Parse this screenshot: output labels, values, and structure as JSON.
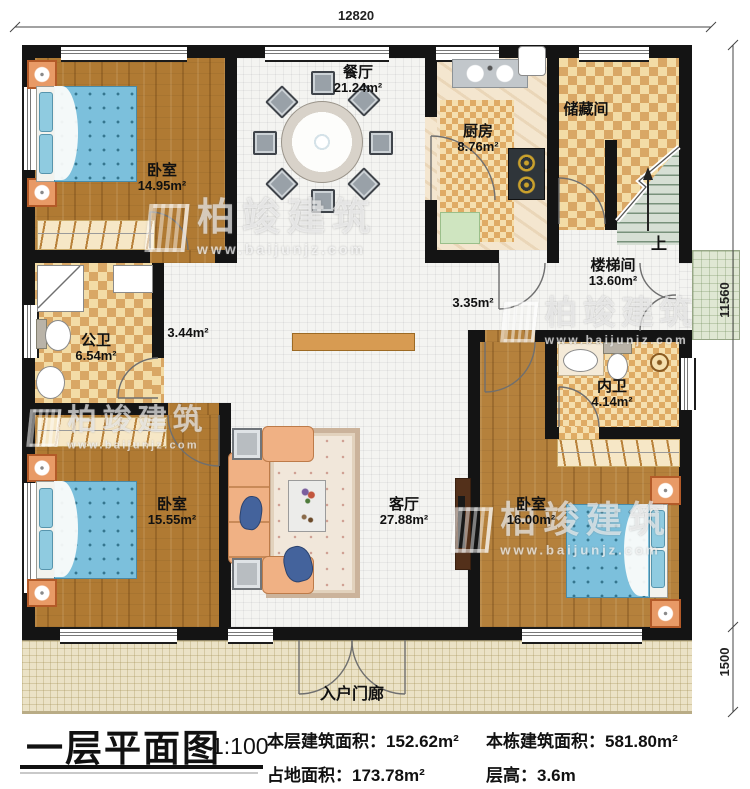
{
  "plan": {
    "title": "一层平面图",
    "scale": "1:100",
    "stats": [
      {
        "label": "本层建筑面积：",
        "value": "152.62m²"
      },
      {
        "label": "本栋建筑面积：",
        "value": "581.80m²"
      },
      {
        "label": "占地面积：",
        "value": "173.78m²"
      },
      {
        "label": "层高：",
        "value": "3.6m"
      }
    ]
  },
  "dimensions": {
    "top": "12820",
    "right_upper": "11560",
    "right_lower": "1500"
  },
  "rooms": [
    {
      "id": "bedroom-top-left",
      "name": "卧室",
      "area": "14.95m²"
    },
    {
      "id": "dining",
      "name": "餐厅",
      "area": "21.24m²"
    },
    {
      "id": "kitchen",
      "name": "厨房",
      "area": "8.76m²"
    },
    {
      "id": "storage",
      "name": "储藏间",
      "area": ""
    },
    {
      "id": "stairwell",
      "name": "楼梯间",
      "area": "13.60m²"
    },
    {
      "id": "hall-right",
      "name": "",
      "area": "3.35m²"
    },
    {
      "id": "hall-left",
      "name": "",
      "area": "3.44m²"
    },
    {
      "id": "bath-public",
      "name": "公卫",
      "area": "6.54m²"
    },
    {
      "id": "bath-ensuite",
      "name": "内卫",
      "area": "4.14m²"
    },
    {
      "id": "bedroom-bottom-left",
      "name": "卧室",
      "area": "15.55m²"
    },
    {
      "id": "living",
      "name": "客厅",
      "area": "27.88m²"
    },
    {
      "id": "bedroom-bottom-right",
      "name": "卧室",
      "area": "16.00m²"
    },
    {
      "id": "entry-porch",
      "name": "入户门廊",
      "area": ""
    }
  ],
  "stairs_up_label": "上",
  "watermark": {
    "brand": "柏竣建筑",
    "url": "www.baijunjz.com"
  },
  "colors": {
    "wall": "#141414",
    "wood_floor": "#b07a33",
    "tile_floor": "#f4f4f1",
    "checker_tile": "#d9a765",
    "mattress": "#7cc0dc",
    "porch": "#ebe2c6"
  }
}
